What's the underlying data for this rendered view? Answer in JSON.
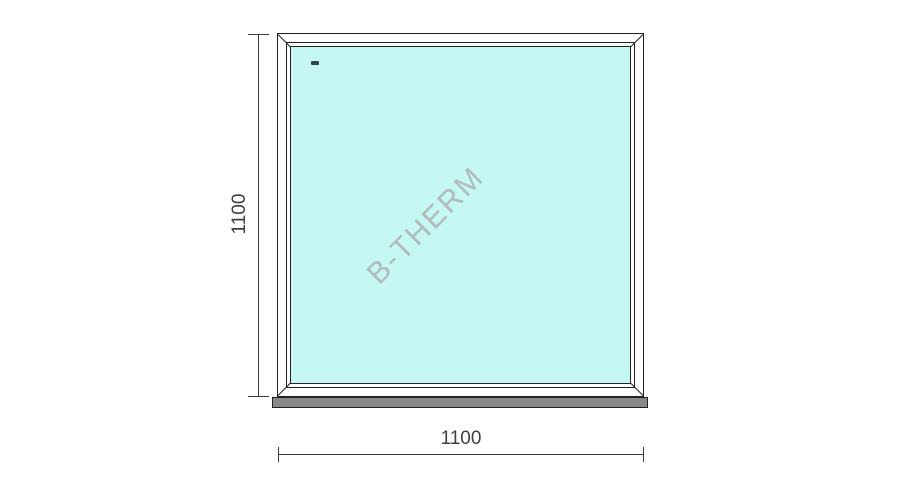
{
  "drawing": {
    "type": "window-technical-drawing",
    "watermark": "B-THERM",
    "height_label": "1100",
    "width_label": "1100",
    "glazing_marker": "fixed-pane-dash",
    "colors": {
      "glass": "#c5f8f2",
      "sill": "#898989",
      "line": "#222222",
      "dimline": "#3a3a3a",
      "dimtext": "#3c4146",
      "watermark": "#b2bbbb",
      "marker": "#38424a"
    }
  }
}
